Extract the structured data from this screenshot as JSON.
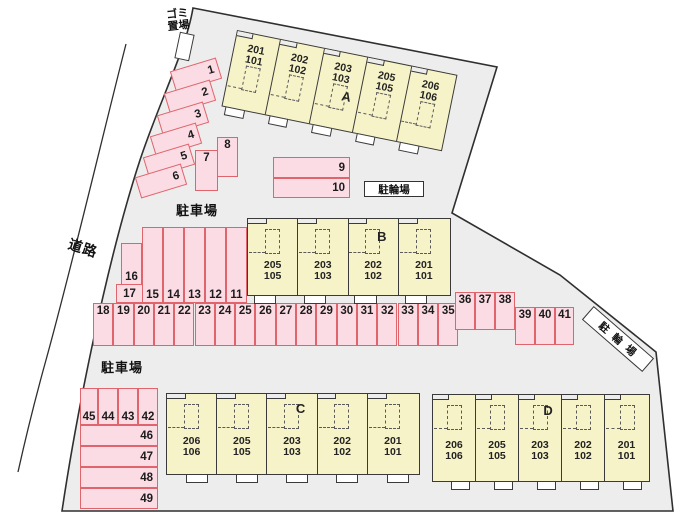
{
  "labels": {
    "road": "道路",
    "garbage_area": "ゴミ置場",
    "parking_top": "駐車場",
    "parking_bottom": "駐車場",
    "bike_top": "駐輪場",
    "bike_right": "駐輪場"
  },
  "buildings": [
    {
      "name": "A",
      "letter": "A",
      "letter_unit_index": 2,
      "units": [
        {
          "upper": "201",
          "lower": "101"
        },
        {
          "upper": "202",
          "lower": "102"
        },
        {
          "upper": "203",
          "lower": "103"
        },
        {
          "upper": "205",
          "lower": "105"
        },
        {
          "upper": "206",
          "lower": "106"
        }
      ]
    },
    {
      "name": "B",
      "letter": "B",
      "letter_unit_index": 2,
      "units": [
        {
          "upper": "205",
          "lower": "105"
        },
        {
          "upper": "203",
          "lower": "103"
        },
        {
          "upper": "202",
          "lower": "102"
        },
        {
          "upper": "201",
          "lower": "101"
        }
      ]
    },
    {
      "name": "C",
      "letter": "C",
      "letter_unit_index": 2,
      "units": [
        {
          "upper": "206",
          "lower": "106"
        },
        {
          "upper": "205",
          "lower": "105"
        },
        {
          "upper": "203",
          "lower": "103"
        },
        {
          "upper": "202",
          "lower": "102"
        },
        {
          "upper": "201",
          "lower": "101"
        }
      ]
    },
    {
      "name": "D",
      "letter": "D",
      "letter_unit_index": 2,
      "units": [
        {
          "upper": "206",
          "lower": "106"
        },
        {
          "upper": "205",
          "lower": "105"
        },
        {
          "upper": "203",
          "lower": "103"
        },
        {
          "upper": "202",
          "lower": "102"
        },
        {
          "upper": "201",
          "lower": "101"
        }
      ]
    }
  ],
  "parking_spaces": [
    "1",
    "2",
    "3",
    "4",
    "5",
    "6",
    "7",
    "8",
    "9",
    "10",
    "11",
    "12",
    "13",
    "14",
    "15",
    "16",
    "17",
    "18",
    "19",
    "20",
    "21",
    "22",
    "23",
    "24",
    "25",
    "26",
    "27",
    "28",
    "29",
    "30",
    "31",
    "32",
    "33",
    "34",
    "35",
    "36",
    "37",
    "38",
    "39",
    "40",
    "41",
    "42",
    "43",
    "44",
    "45",
    "46",
    "47",
    "48",
    "49"
  ],
  "colors": {
    "site_fill": "#EDEDED",
    "outline": "#2F2F2F",
    "building_fill": "#F7F3C8",
    "building_border": "#3A3A3A",
    "parking_fill": "#FCDCE4",
    "parking_border": "#E0646C"
  }
}
